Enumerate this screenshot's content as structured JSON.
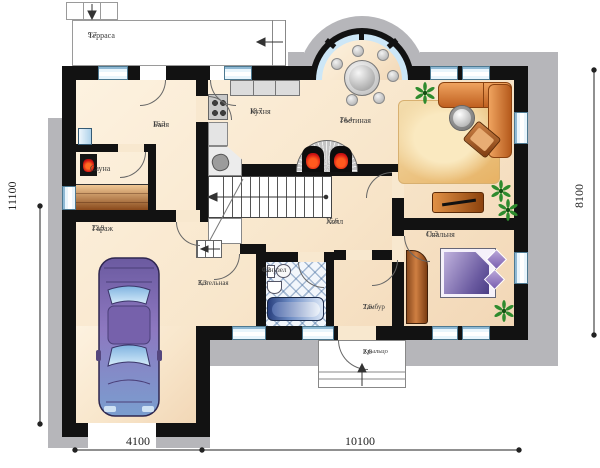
{
  "rooms": {
    "terrace": {
      "name": "Терраса",
      "area": "9,7"
    },
    "banya": {
      "name": "Баня",
      "area": "16,3"
    },
    "sauna": {
      "name": "Сауна",
      "area": ""
    },
    "garage": {
      "name": "Гараж",
      "area": "22,9"
    },
    "kitchen": {
      "name": "Кухня",
      "area": "10,7"
    },
    "living": {
      "name": "Гостиная",
      "area": "24,4"
    },
    "hall": {
      "name": "Холл",
      "area": "15,6"
    },
    "bathroom": {
      "name": "Санузел",
      "area": "4,2"
    },
    "boiler": {
      "name": "Котельная",
      "area": "3,3"
    },
    "tambour": {
      "name": "Тамбур",
      "area": "2,6"
    },
    "bedroom": {
      "name": "Спальня",
      "area": "11,3"
    },
    "porch": {
      "name": "Крыльцо",
      "area": "2,6"
    }
  },
  "dimensions": {
    "left": "11100",
    "right": "8100",
    "bottom_left": "4100",
    "bottom_right": "10100"
  },
  "colors": {
    "wall": "#121212",
    "floor_light": "#fdf2e0",
    "floor_dark": "#f2d7b6",
    "blind_area": "#b6b6ba",
    "window": "#cde7f7",
    "sofa": "#d97a2e",
    "bed": "#6a5aa0",
    "car": "#8d78c0",
    "rug": "#edbd6f",
    "wood": "#b05e24",
    "plant": "#2e8b2e",
    "flame": "#d01212",
    "tub": "#4a66a8"
  }
}
